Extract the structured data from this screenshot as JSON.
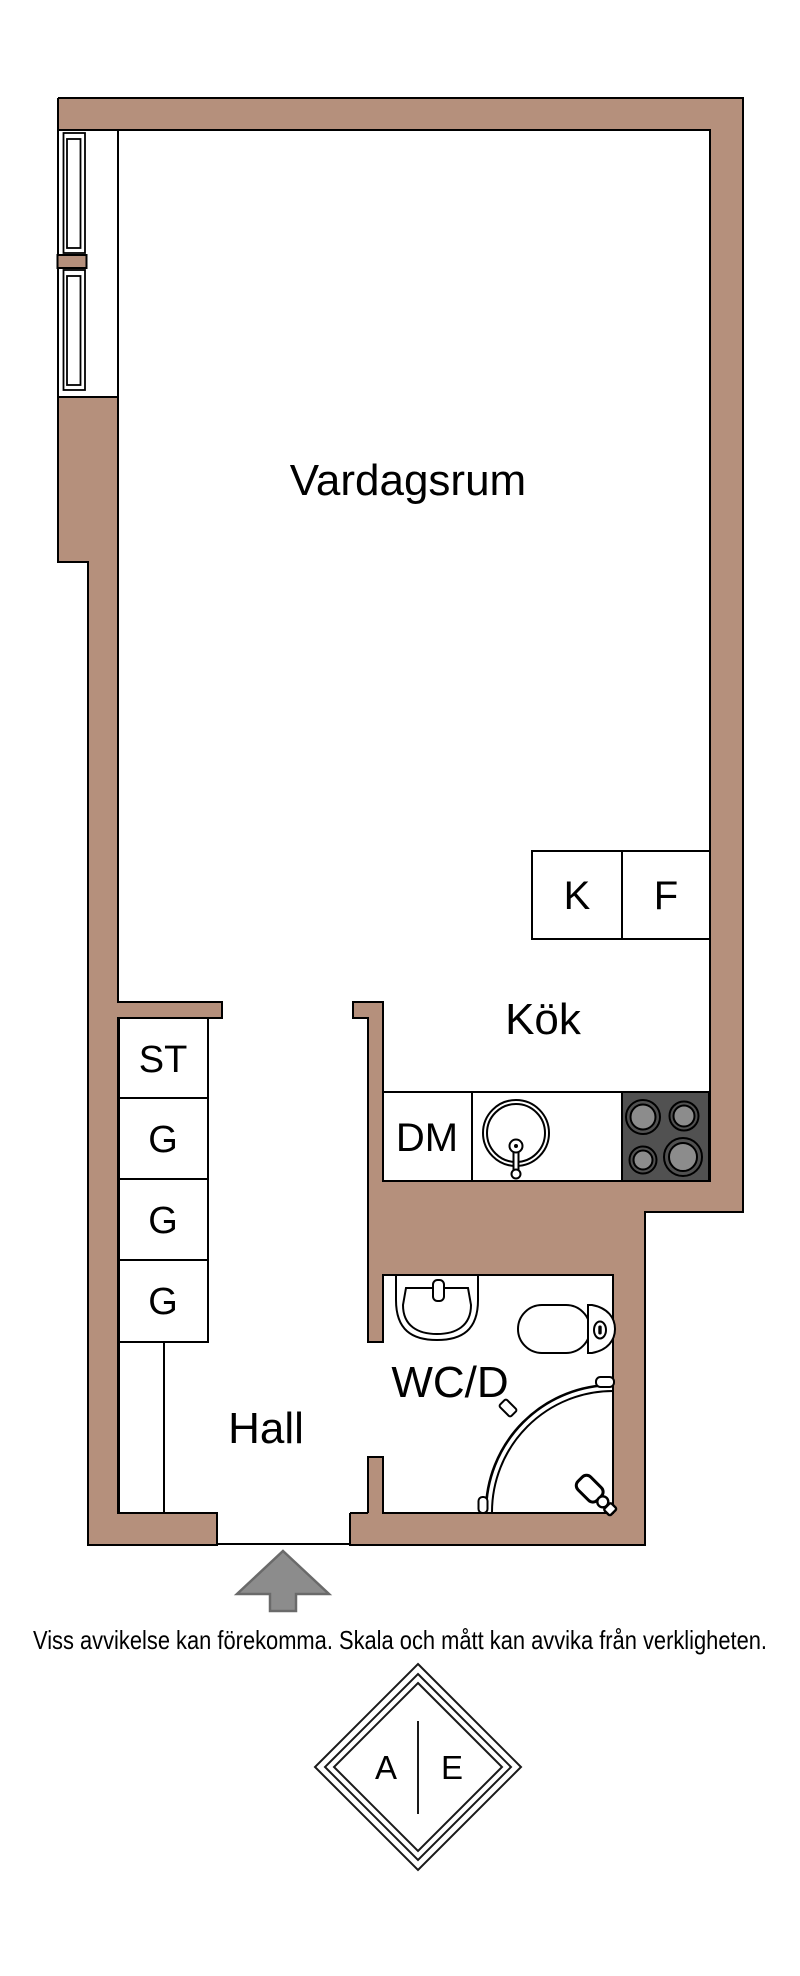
{
  "floorplan": {
    "rooms": {
      "living": "Vardagsrum",
      "kitchen": "Kök",
      "hall": "Hall",
      "bathroom": "WC/D"
    },
    "appliances": {
      "fridge": "K",
      "freezer": "F",
      "dishwasher": "DM"
    },
    "closets": {
      "st": "ST",
      "g1": "G",
      "g2": "G",
      "g3": "G"
    }
  },
  "footer": {
    "disclaimer": "Viss avvikelse kan förekomma. Skala och mått kan avvika från verkligheten."
  },
  "logo": {
    "left": "A",
    "right": "E"
  },
  "colors": {
    "wall": "#B5907C",
    "line": "#000000",
    "stove": "#515151",
    "burner": "#8C8C8C",
    "arrow_fill": "#8C8C8C",
    "arrow_stroke": "#6A6A6A"
  }
}
